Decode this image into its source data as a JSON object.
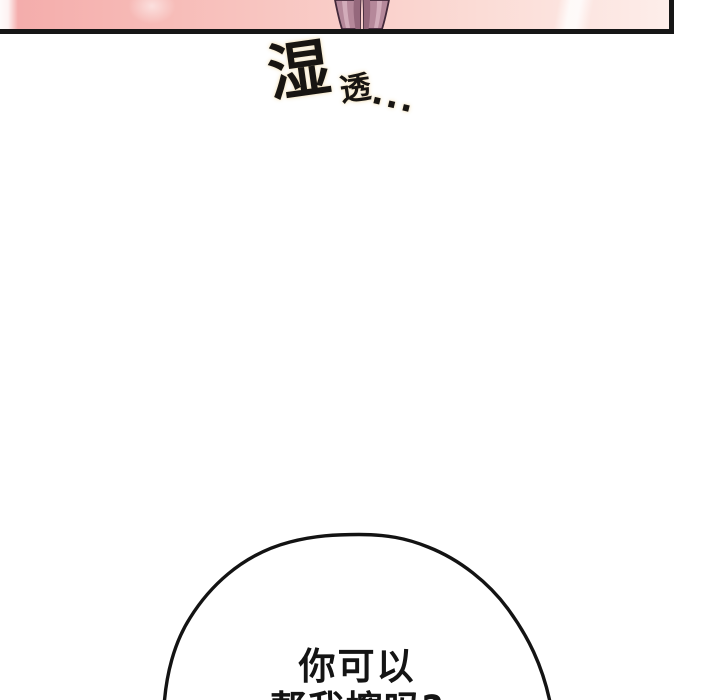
{
  "page": {
    "background_color": "#ffffff",
    "type": "webtoon-comic-segment"
  },
  "panel": {
    "art": "crossed-legs",
    "colors": {
      "pink_left": "#f4abaa",
      "pink_mid": "#f9ccc7",
      "pink_right": "#fdeeea",
      "border": "#161616",
      "legs_fill": "#b5889a",
      "legs_shadow": "#95687c",
      "legs_highlight": "#d7b3bf",
      "legs_outline": "#43293a"
    }
  },
  "sfx": {
    "full_text": "湿透...",
    "char_large": "湿",
    "char_small": "透",
    "ellipsis": "...",
    "text_color": "#181512",
    "glow_color": "#f3e2bb"
  },
  "bubble": {
    "line1": "你可以",
    "line2": "帮我擦吗?",
    "full_text": "你可以帮我擦吗?",
    "stroke_color": "#131313",
    "fill_color": "#ffffff",
    "text_color": "#141414"
  }
}
